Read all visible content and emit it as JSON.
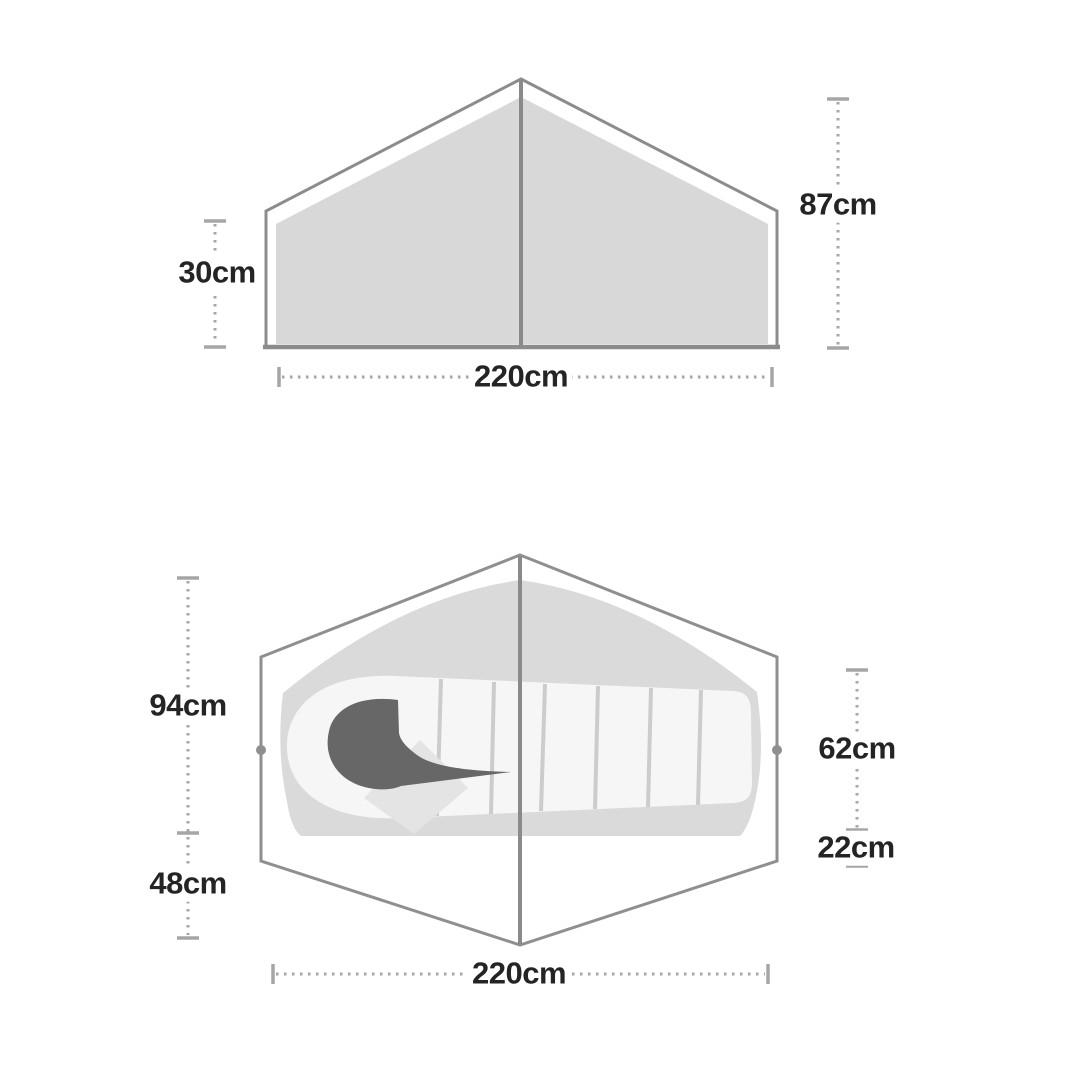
{
  "diagram_title": "tent dimension diagram",
  "side_view": {
    "name": "tent side elevation",
    "dim_left": "30cm",
    "dim_right": "87cm",
    "dim_bottom": "220cm"
  },
  "floor_plan": {
    "name": "tent floor plan with sleeping bag",
    "dim_left_upper": "94cm",
    "dim_left_lower": "48cm",
    "dim_right_upper": "62cm",
    "dim_right_lower": "22cm",
    "dim_bottom": "220cm"
  },
  "colors": {
    "background": "#ffffff",
    "outline_gray": "#8c8c8c",
    "fabric_fill_gray": "#d8d8d8",
    "inner_floor_gray": "#dadada",
    "sleeping_bag_white": "#f6f6f6",
    "bag_seam_gray": "#cccccc",
    "hood_dark_gray": "#676767",
    "pillow_gray": "#e4e4e4",
    "dimension_line_gray": "#a6a6a6",
    "label_text": "#242424"
  }
}
